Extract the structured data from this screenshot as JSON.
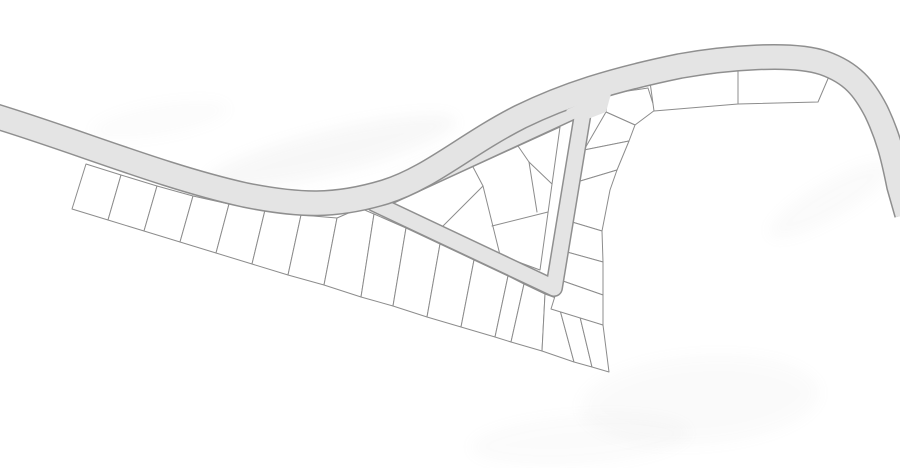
{
  "canvas": {
    "width": 900,
    "height": 468,
    "background": "#ffffff"
  },
  "palette": {
    "road_fill": "#e4e4e4",
    "road_edge": "#8f8f8f",
    "parcel_line": "#8c8c8c",
    "parcel_fill": "#ffffff",
    "watermark": "#a9a9a9"
  },
  "roads": {
    "main": {
      "path": "M -15 113 C 70 138, 160 176, 245 195 C 300 206, 335 207, 385 192 C 430 178, 465 145, 520 117 C 565 95, 612 80, 680 66 C 725 58, 792 52, 824 63 C 852 73, 864 88, 876 111 C 888 136, 893 156, 899 186 L 907 214",
      "outer_width": 26,
      "inner_width": 23
    },
    "loop": {
      "path": "M 374 203 L 584 106 L 554 288 Z",
      "outer_width": 18,
      "inner_width": 15
    },
    "junction_patch": [
      [
        566,
        110
      ],
      [
        612,
        90
      ],
      [
        606,
        112
      ],
      [
        580,
        122
      ]
    ]
  },
  "parcels": {
    "southwest_row": [
      [
        [
          86,
          164
        ],
        [
          121,
          175
        ],
        [
          108,
          220
        ],
        [
          72,
          209
        ]
      ],
      [
        [
          121,
          175
        ],
        [
          157,
          186
        ],
        [
          144,
          231
        ],
        [
          108,
          220
        ]
      ],
      [
        [
          157,
          186
        ],
        [
          193,
          196
        ],
        [
          180,
          242
        ],
        [
          144,
          231
        ]
      ],
      [
        [
          193,
          196
        ],
        [
          229,
          204
        ],
        [
          216,
          253
        ],
        [
          180,
          242
        ]
      ],
      [
        [
          229,
          204
        ],
        [
          265,
          210
        ],
        [
          252,
          264
        ],
        [
          216,
          253
        ]
      ],
      [
        [
          265,
          210
        ],
        [
          301,
          215
        ],
        [
          288,
          275
        ],
        [
          252,
          264
        ]
      ],
      [
        [
          301,
          215
        ],
        [
          337,
          218
        ],
        [
          324,
          285
        ],
        [
          288,
          275
        ]
      ],
      [
        [
          337,
          218
        ],
        [
          360,
          208
        ],
        [
          374,
          214
        ],
        [
          361,
          297
        ],
        [
          324,
          285
        ]
      ],
      [
        [
          374,
          214
        ],
        [
          406,
          228
        ],
        [
          393,
          306
        ],
        [
          361,
          297
        ]
      ],
      [
        [
          406,
          228
        ],
        [
          440,
          244
        ],
        [
          427,
          317
        ],
        [
          393,
          306
        ]
      ],
      [
        [
          440,
          244
        ],
        [
          474,
          260
        ],
        [
          461,
          327
        ],
        [
          427,
          317
        ]
      ],
      [
        [
          474,
          260
        ],
        [
          508,
          276
        ],
        [
          495,
          337
        ],
        [
          461,
          327
        ]
      ],
      [
        [
          508,
          276
        ],
        [
          524,
          284
        ],
        [
          511,
          342
        ],
        [
          495,
          337
        ]
      ],
      [
        [
          524,
          284
        ],
        [
          545,
          294
        ],
        [
          542,
          351
        ],
        [
          511,
          342
        ]
      ],
      [
        [
          545,
          294
        ],
        [
          556,
          298
        ],
        [
          560,
          310
        ],
        [
          574,
          362
        ],
        [
          542,
          351
        ]
      ],
      [
        [
          560,
          310
        ],
        [
          580,
          317
        ],
        [
          592,
          367
        ],
        [
          574,
          362
        ]
      ],
      [
        [
          580,
          317
        ],
        [
          603,
          325
        ],
        [
          609,
          372
        ],
        [
          592,
          367
        ]
      ]
    ],
    "east_column": [
      [
        [
          608,
          94
        ],
        [
          648,
          88
        ],
        [
          655,
          110
        ],
        [
          635,
          125
        ],
        [
          606,
          112
        ]
      ],
      [
        [
          606,
          112
        ],
        [
          635,
          125
        ],
        [
          629,
          141
        ],
        [
          584,
          150
        ]
      ],
      [
        [
          584,
          150
        ],
        [
          629,
          141
        ],
        [
          617,
          170
        ],
        [
          577,
          182
        ]
      ],
      [
        [
          577,
          182
        ],
        [
          617,
          170
        ],
        [
          610,
          190
        ],
        [
          602,
          231
        ],
        [
          572,
          222
        ]
      ],
      [
        [
          572,
          222
        ],
        [
          602,
          231
        ],
        [
          603,
          262
        ],
        [
          567,
          252
        ]
      ],
      [
        [
          567,
          252
        ],
        [
          603,
          262
        ],
        [
          603,
          295
        ],
        [
          560,
          280
        ]
      ],
      [
        [
          560,
          280
        ],
        [
          603,
          295
        ],
        [
          603,
          325
        ],
        [
          551,
          309
        ]
      ]
    ],
    "northeast": [
      [
        [
          650,
          82
        ],
        [
          738,
          70
        ],
        [
          738,
          104
        ],
        [
          654,
          111
        ]
      ],
      [
        [
          738,
          70
        ],
        [
          812,
          66
        ],
        [
          830,
          74
        ],
        [
          818,
          102
        ],
        [
          738,
          104
        ]
      ]
    ],
    "island_outline": [
      [
        560,
        127
      ],
      [
        378,
        210
      ],
      [
        540,
        270
      ]
    ],
    "island_lines": [
      [
        [
          473,
          167
        ],
        [
          483,
          186
        ]
      ],
      [
        [
          483,
          186
        ],
        [
          437,
          232
        ]
      ],
      [
        [
          483,
          186
        ],
        [
          500,
          255
        ]
      ],
      [
        [
          518,
          146
        ],
        [
          529,
          162
        ]
      ],
      [
        [
          529,
          162
        ],
        [
          552,
          184
        ]
      ],
      [
        [
          529,
          162
        ],
        [
          537,
          212
        ]
      ],
      [
        [
          548,
          212
        ],
        [
          492,
          226
        ]
      ]
    ]
  },
  "watermark": {
    "smudges": [
      {
        "cx": 330,
        "cy": 152,
        "rx": 130,
        "ry": 22,
        "rot": -14,
        "opacity": 0.08
      },
      {
        "cx": 470,
        "cy": 163,
        "rx": 90,
        "ry": 16,
        "rot": -18,
        "opacity": 0.07
      },
      {
        "cx": 830,
        "cy": 200,
        "rx": 70,
        "ry": 18,
        "rot": -30,
        "opacity": 0.05
      },
      {
        "cx": 700,
        "cy": 400,
        "rx": 120,
        "ry": 45,
        "rot": -4,
        "opacity": 0.045
      },
      {
        "cx": 580,
        "cy": 440,
        "rx": 110,
        "ry": 25,
        "rot": -4,
        "opacity": 0.04
      },
      {
        "cx": 160,
        "cy": 120,
        "rx": 70,
        "ry": 16,
        "rot": -10,
        "opacity": 0.035
      }
    ]
  }
}
